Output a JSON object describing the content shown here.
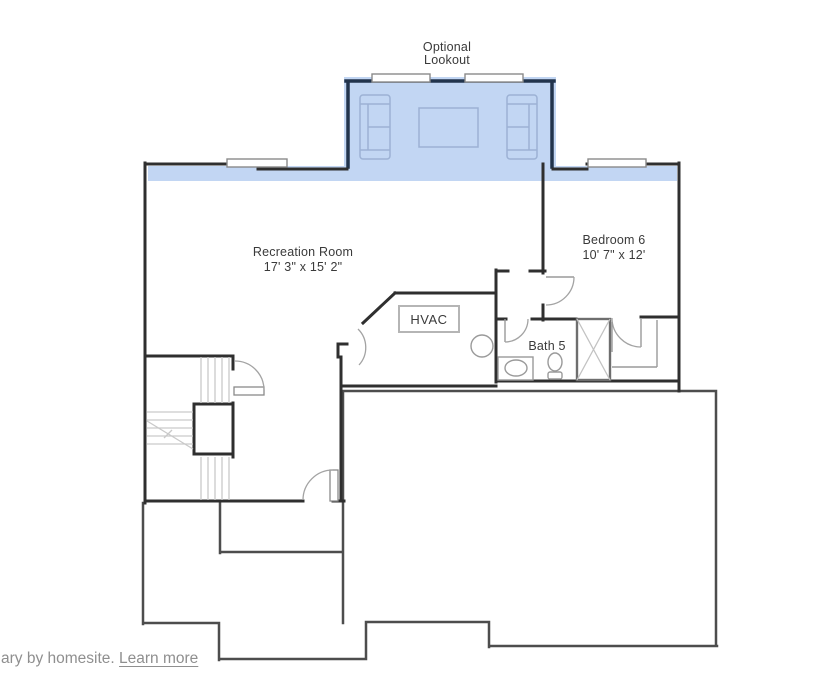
{
  "plan": {
    "optional_lookout": {
      "line1": "Optional",
      "line2": "Lookout"
    },
    "rooms": {
      "recreation": {
        "name": "Recreation Room",
        "dims": "17' 3\" x 15' 2\""
      },
      "bedroom6": {
        "name": "Bedroom 6",
        "dims": "10' 7\" x 12'"
      },
      "bath5": {
        "name": "Bath 5"
      },
      "hvac": {
        "name": "HVAC"
      }
    }
  },
  "footer": {
    "text": "ary by homesite.",
    "link": "Learn more"
  },
  "colors": {
    "wall": "#2f2f2f",
    "wall-med": "#4d4d4d",
    "wall-navy": "#22344c",
    "blue": "#c2d6f3",
    "fixture": "#9a9a9a",
    "stair": "#c9c9c9",
    "furn": "#9cb1d4",
    "ink": "#3a3a3a",
    "muted": "#8f8f8f"
  }
}
